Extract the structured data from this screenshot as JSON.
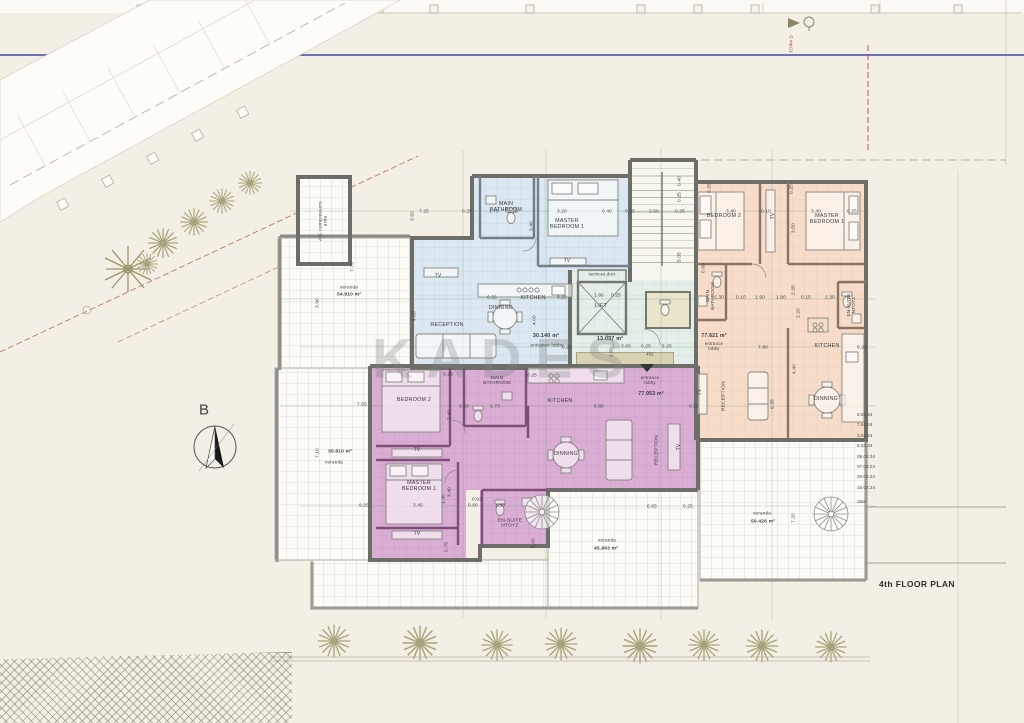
{
  "plan": {
    "title": "4th FLOOR PLAN",
    "north_label": "B",
    "watermark": "KADES",
    "boundary_note": "TOΦ4 D"
  },
  "title_block": {
    "revisions": [
      "8.04.24",
      "7.04.24",
      "3.04.24",
      "8.03.24",
      "09.03.24",
      "07.03.24",
      "29.02.24",
      "15.02.24"
    ],
    "revisions_footer": "date"
  },
  "colors": {
    "paper": "#f3efe4",
    "blue_apartment": "#dce8f1",
    "orange_apartment": "#f7ddc9",
    "purple_apartment": "#d9add4",
    "core_lobby": "#e3efe8",
    "wall_gray": "#6e6e68",
    "purple_wall": "#7c4f74",
    "boundary_blue_line": "#5b5ea8",
    "red_marker": "#a8453c"
  },
  "apartments": {
    "blue": {
      "rooms": [
        "MAIN BATHROOM",
        "MASTER BEDROOM 1",
        "TV",
        "RECEPTION",
        "DINNING",
        "KITCHEN"
      ],
      "entrance_lobby_area": "30.140 m²",
      "veranda_area": "54.910 m²"
    },
    "orange": {
      "rooms": [
        "BEDROOM 2",
        "TV",
        "MASTER BEDROOM 1",
        "MAIN BATHROOM",
        "EN-SUITE NTOYZ",
        "KITCHEN",
        "DINNING",
        "RECEPTION"
      ],
      "entrance_lobby_area": "77.621 m²",
      "veranda_area": "50.426 m²"
    },
    "purple": {
      "rooms": [
        "BEDROOM 2",
        "MAIN BATHROOM",
        "KITCHEN",
        "DINNING",
        "TV",
        "MASTER BEDROOM 1",
        "EN-SUITE NTOYZ",
        "RECEPTION"
      ],
      "entrance_lobby_area": "77.953 m²",
      "veranda_area": "30.810 m²"
    },
    "common": {
      "rooms": [
        "LIFT",
        "services duct"
      ],
      "lobby_area": "13.037 m²",
      "door_number": "402",
      "bottom_veranda_area": "45.963 m²"
    }
  },
  "labels": [
    {
      "n": "room-label-main-bathroom-blue",
      "t": "MAIN\nBATHROOM",
      "x": 506,
      "y": 207,
      "s": 5.4
    },
    {
      "n": "room-label-master-bedroom1-blue",
      "t": "MASTER\nBEDROOM 1",
      "x": 567,
      "y": 224,
      "s": 5.4
    },
    {
      "n": "room-label-tv-blue",
      "t": "TV",
      "x": 567,
      "y": 262,
      "s": 5
    },
    {
      "n": "room-label-tv2-blue",
      "t": "TV",
      "x": 438,
      "y": 277,
      "s": 5
    },
    {
      "n": "room-label-reception-blue",
      "t": "RECEPTION",
      "x": 447,
      "y": 325,
      "s": 5.4
    },
    {
      "n": "room-label-dinning-blue",
      "t": "DINNING",
      "x": 501,
      "y": 308,
      "s": 5.4
    },
    {
      "n": "room-label-kitchen-blue",
      "t": "KITCHEN",
      "x": 533,
      "y": 298,
      "s": 5.4
    },
    {
      "n": "area-label-blue-lobby",
      "t": "30.140 m²",
      "x": 546,
      "y": 336,
      "s": 5.4,
      "w": 700
    },
    {
      "n": "label-entrance-lobby-blue",
      "t": "entrance lobby",
      "x": 547,
      "y": 345,
      "s": 4.6
    },
    {
      "n": "room-label-ac-compressors",
      "t": "A/C compressors\narea",
      "x": 324,
      "y": 221,
      "r": -90,
      "s": 4.8
    },
    {
      "n": "label-veranda-blue",
      "t": "veranda",
      "x": 349,
      "y": 287,
      "s": 4.6
    },
    {
      "n": "area-label-veranda-blue",
      "t": "54.910 m²",
      "x": 349,
      "y": 295,
      "s": 4.9,
      "w": 700
    },
    {
      "n": "label-services-duct",
      "t": "services duct",
      "x": 602,
      "y": 275,
      "s": 4.2
    },
    {
      "n": "room-label-lift",
      "t": "LIFT",
      "x": 601,
      "y": 306,
      "s": 5.4
    },
    {
      "n": "area-label-core-lobby",
      "t": "13.037 m²",
      "x": 610,
      "y": 339,
      "s": 5.4,
      "w": 700
    },
    {
      "n": "label-door-402",
      "t": "402",
      "x": 650,
      "y": 355,
      "s": 4.2
    },
    {
      "n": "room-label-bedroom2-orange",
      "t": "BEDROOM 2",
      "x": 724,
      "y": 216,
      "s": 5.4
    },
    {
      "n": "room-label-tv-orange",
      "t": "TV",
      "x": 774,
      "y": 216,
      "r": -90,
      "s": 5
    },
    {
      "n": "room-label-master-bedroom1-orange",
      "t": "MASTER\nBEDROOM 1",
      "x": 827,
      "y": 219,
      "s": 5.4
    },
    {
      "n": "room-label-main-bathroom-orange",
      "t": "MAIN\nBATHROOM",
      "x": 710,
      "y": 296,
      "r": -90,
      "s": 4.6
    },
    {
      "n": "room-label-ensuite-orange",
      "t": "EN-SUITE\nNTOYZ",
      "x": 851,
      "y": 305,
      "r": -90,
      "s": 4.6
    },
    {
      "n": "room-label-kitchen-orange",
      "t": "KITCHEN",
      "x": 827,
      "y": 346,
      "s": 5.4
    },
    {
      "n": "area-label-orange-lobby",
      "t": "77.621 m²",
      "x": 714,
      "y": 337,
      "s": 5.2,
      "w": 700
    },
    {
      "n": "label-entrance-lobby-orange",
      "t": "entrance\nlobby",
      "x": 714,
      "y": 347,
      "s": 4.3
    },
    {
      "n": "room-label-dinning-orange",
      "t": "DINNING",
      "x": 826,
      "y": 399,
      "s": 5.4
    },
    {
      "n": "room-label-reception-orange",
      "t": "RECEPTION",
      "x": 724,
      "y": 396,
      "r": -90,
      "s": 4.8
    },
    {
      "n": "room-label-tv2-orange",
      "t": "TV",
      "x": 701,
      "y": 392,
      "r": -90,
      "s": 5
    },
    {
      "n": "room-label-bedroom2-purple",
      "t": "BEDROOM 2",
      "x": 414,
      "y": 400,
      "s": 5.4
    },
    {
      "n": "room-label-main-bathroom-purple",
      "t": "MAIN\nBATHROOM",
      "x": 497,
      "y": 380,
      "s": 4.6
    },
    {
      "n": "room-label-kitchen-purple",
      "t": "KITCHEN",
      "x": 560,
      "y": 401,
      "s": 5.4
    },
    {
      "n": "room-label-dinning-purple",
      "t": "DINNING",
      "x": 566,
      "y": 454,
      "s": 5.4
    },
    {
      "n": "room-label-tv-purple",
      "t": "TV",
      "x": 417,
      "y": 451,
      "s": 5
    },
    {
      "n": "room-label-master-bedroom1-purple",
      "t": "MASTER\nBEDROOM 1",
      "x": 419,
      "y": 486,
      "s": 5.4
    },
    {
      "n": "room-label-tv2-purple",
      "t": "TV",
      "x": 417,
      "y": 535,
      "s": 5
    },
    {
      "n": "room-label-ensuite-purple",
      "t": "EN-SUITE\nNTOYZ",
      "x": 510,
      "y": 524,
      "s": 4.9
    },
    {
      "n": "room-label-reception-purple",
      "t": "RECEPTION",
      "x": 657,
      "y": 450,
      "r": -90,
      "s": 4.8
    },
    {
      "n": "room-label-tv3-purple",
      "t": "TV",
      "x": 680,
      "y": 447,
      "r": -90,
      "s": 5
    },
    {
      "n": "label-entrance-lobby-purple",
      "t": "entrance\nlobby",
      "x": 650,
      "y": 381,
      "s": 4.3
    },
    {
      "n": "area-label-purple-lobby",
      "t": "77.953 m²",
      "x": 651,
      "y": 395,
      "s": 5.2,
      "w": 700
    },
    {
      "n": "area-label-veranda-purple",
      "t": "30.810 m²",
      "x": 340,
      "y": 452,
      "s": 4.9,
      "w": 700
    },
    {
      "n": "label-veranda-purple",
      "t": "veranda",
      "x": 334,
      "y": 462,
      "s": 4.6
    },
    {
      "n": "label-veranda-bottom",
      "t": "veranda",
      "x": 607,
      "y": 540,
      "s": 4.6
    },
    {
      "n": "area-label-veranda-bottom",
      "t": "45.963 m²",
      "x": 606,
      "y": 549,
      "s": 4.9,
      "w": 700
    },
    {
      "n": "label-veranda-right",
      "t": "veranda",
      "x": 762,
      "y": 513,
      "s": 4.6
    },
    {
      "n": "area-label-veranda-right",
      "t": "50.426 m²",
      "x": 763,
      "y": 522,
      "s": 4.9,
      "w": 700
    },
    {
      "n": "dim",
      "t": "7.25",
      "x": 424,
      "y": 211,
      "s": 4.7
    },
    {
      "n": "dim",
      "t": "0.25",
      "x": 467,
      "y": 211,
      "s": 4.7
    },
    {
      "n": "dim",
      "t": "1.79",
      "x": 494,
      "y": 211,
      "s": 4.7
    },
    {
      "n": "dim",
      "t": "0.10",
      "x": 513,
      "y": 211,
      "s": 4.7
    },
    {
      "n": "dim",
      "t": "3.20",
      "x": 562,
      "y": 211,
      "s": 4.7
    },
    {
      "n": "dim",
      "t": "0.40",
      "x": 607,
      "y": 211,
      "s": 4.7
    },
    {
      "n": "dim",
      "t": "0.25",
      "x": 630,
      "y": 211,
      "s": 4.7
    },
    {
      "n": "dim",
      "t": "2.50",
      "x": 654,
      "y": 211,
      "s": 4.7
    },
    {
      "n": "dim",
      "t": "0.25",
      "x": 680,
      "y": 211,
      "s": 4.7
    },
    {
      "n": "dim",
      "t": "3.40",
      "x": 731,
      "y": 211,
      "s": 4.7
    },
    {
      "n": "dim",
      "t": "0.10",
      "x": 766,
      "y": 211,
      "s": 4.7
    },
    {
      "n": "dim",
      "t": "3.40",
      "x": 816,
      "y": 211,
      "s": 4.7
    },
    {
      "n": "dim",
      "t": "0.25",
      "x": 852,
      "y": 211,
      "s": 4.7
    },
    {
      "n": "dim",
      "t": "6.55",
      "x": 492,
      "y": 297,
      "s": 4.7
    },
    {
      "n": "dim",
      "t": "0.25",
      "x": 562,
      "y": 297,
      "s": 4.7
    },
    {
      "n": "dim",
      "t": "1.86",
      "x": 599,
      "y": 295,
      "s": 4.7
    },
    {
      "n": "dim",
      "t": "0.25",
      "x": 616,
      "y": 295,
      "s": 4.7
    },
    {
      "n": "dim",
      "t": "2.30",
      "x": 719,
      "y": 297,
      "s": 4.7
    },
    {
      "n": "dim",
      "t": "0.10",
      "x": 741,
      "y": 297,
      "s": 4.7
    },
    {
      "n": "dim",
      "t": "1.90",
      "x": 760,
      "y": 297,
      "s": 4.7
    },
    {
      "n": "dim",
      "t": "1.90",
      "x": 781,
      "y": 297,
      "s": 4.7
    },
    {
      "n": "dim",
      "t": "0.15",
      "x": 806,
      "y": 297,
      "s": 4.7
    },
    {
      "n": "dim",
      "t": "2.30",
      "x": 830,
      "y": 297,
      "s": 4.7
    },
    {
      "n": "dim",
      "t": "0.25",
      "x": 567,
      "y": 347,
      "s": 4.7
    },
    {
      "n": "dim",
      "t": "3.65",
      "x": 626,
      "y": 346,
      "s": 4.7
    },
    {
      "n": "dim",
      "t": "0.25",
      "x": 646,
      "y": 346,
      "s": 4.7
    },
    {
      "n": "dim",
      "t": "6.25",
      "x": 667,
      "y": 346,
      "s": 4.7
    },
    {
      "n": "dim",
      "t": "7.80",
      "x": 763,
      "y": 347,
      "s": 4.7
    },
    {
      "n": "dim",
      "t": "7.65",
      "x": 362,
      "y": 404,
      "s": 4.7
    },
    {
      "n": "dim",
      "t": "0.60",
      "x": 464,
      "y": 406,
      "s": 4.7
    },
    {
      "n": "dim",
      "t": "1.73",
      "x": 495,
      "y": 406,
      "s": 4.7
    },
    {
      "n": "dim",
      "t": "6.80",
      "x": 599,
      "y": 406,
      "s": 4.7
    },
    {
      "n": "dim",
      "t": "0.25",
      "x": 694,
      "y": 406,
      "s": 4.7
    },
    {
      "n": "dim",
      "t": "9.25",
      "x": 364,
      "y": 505,
      "s": 4.7
    },
    {
      "n": "dim",
      "t": "3.45",
      "x": 418,
      "y": 505,
      "s": 4.7
    },
    {
      "n": "dim",
      "t": "0.60",
      "x": 473,
      "y": 505,
      "s": 4.7
    },
    {
      "n": "dim",
      "t": "1.50",
      "x": 500,
      "y": 505,
      "s": 4.7
    },
    {
      "n": "dim",
      "t": "0.93",
      "x": 477,
      "y": 499,
      "s": 4.7
    },
    {
      "n": "dim",
      "t": "6.65",
      "x": 652,
      "y": 506,
      "s": 4.7
    },
    {
      "n": "dim",
      "t": "0.25",
      "x": 688,
      "y": 506,
      "s": 4.7
    },
    {
      "n": "dim",
      "t": "0.25",
      "x": 862,
      "y": 347,
      "s": 4.7
    },
    {
      "n": "dim",
      "t": "0.25",
      "x": 448,
      "y": 374,
      "s": 4.7
    },
    {
      "n": "dim",
      "t": "0.25",
      "x": 532,
      "y": 375,
      "s": 4.7
    },
    {
      "n": "dim",
      "t": "3.50",
      "x": 412,
      "y": 216,
      "r": -90,
      "s": 4.7
    },
    {
      "n": "dim",
      "t": "3.40",
      "x": 531,
      "y": 226,
      "r": -90,
      "s": 4.7
    },
    {
      "n": "dim",
      "t": "7.75",
      "x": 352,
      "y": 267,
      "r": -90,
      "s": 4.7
    },
    {
      "n": "dim",
      "t": "3.90",
      "x": 317,
      "y": 303,
      "r": -90,
      "s": 4.7
    },
    {
      "n": "dim",
      "t": "7.10",
      "x": 317,
      "y": 453,
      "r": -90,
      "s": 4.7
    },
    {
      "n": "dim",
      "t": "4.00",
      "x": 414,
      "y": 316,
      "r": -90,
      "s": 4.7
    },
    {
      "n": "dim",
      "t": "4.00",
      "x": 534,
      "y": 320,
      "r": -90,
      "s": 4.7
    },
    {
      "n": "dim",
      "t": "0.40",
      "x": 679,
      "y": 181,
      "r": -90,
      "s": 4.7
    },
    {
      "n": "dim",
      "t": "0.25",
      "x": 679,
      "y": 197,
      "r": -90,
      "s": 4.7
    },
    {
      "n": "dim",
      "t": "5.05",
      "x": 679,
      "y": 257,
      "r": -90,
      "s": 4.7
    },
    {
      "n": "dim",
      "t": "0.25",
      "x": 709,
      "y": 188,
      "r": -90,
      "s": 4.7
    },
    {
      "n": "dim",
      "t": "0.25",
      "x": 791,
      "y": 189,
      "r": -90,
      "s": 4.7
    },
    {
      "n": "dim",
      "t": "3.50",
      "x": 793,
      "y": 228,
      "r": -90,
      "s": 4.7
    },
    {
      "n": "dim",
      "t": "2.25",
      "x": 793,
      "y": 290,
      "r": -90,
      "s": 4.7
    },
    {
      "n": "dim",
      "t": "0.60",
      "x": 703,
      "y": 268,
      "r": -90,
      "s": 4.7
    },
    {
      "n": "dim",
      "t": "2.20",
      "x": 798,
      "y": 313,
      "r": -90,
      "s": 4.7
    },
    {
      "n": "dim",
      "t": "4.40",
      "x": 794,
      "y": 369,
      "r": -90,
      "s": 4.7
    },
    {
      "n": "dim",
      "t": "6.95",
      "x": 772,
      "y": 404,
      "r": -90,
      "s": 4.7
    },
    {
      "n": "dim",
      "t": "3.40",
      "x": 449,
      "y": 415,
      "r": -90,
      "s": 4.7
    },
    {
      "n": "dim",
      "t": "3.40",
      "x": 449,
      "y": 492,
      "r": -90,
      "s": 4.7
    },
    {
      "n": "dim",
      "t": "5.05",
      "x": 533,
      "y": 543,
      "r": -90,
      "s": 4.7
    },
    {
      "n": "dim",
      "t": "7.20",
      "x": 793,
      "y": 518,
      "r": -90,
      "s": 4.7
    },
    {
      "n": "dim",
      "t": "1.50",
      "x": 611,
      "y": 352,
      "r": -90,
      "s": 4.7
    },
    {
      "n": "dim",
      "t": "0.75",
      "x": 446,
      "y": 547,
      "r": -90,
      "s": 4.7
    },
    {
      "n": "dim",
      "t": "1.40",
      "x": 443,
      "y": 499,
      "r": -90,
      "s": 4.7
    },
    {
      "n": "boundary-note",
      "t": "TOΦ4 D",
      "x": 791,
      "y": 44,
      "r": -90,
      "s": 4.5,
      "c": "#a8453c"
    }
  ]
}
